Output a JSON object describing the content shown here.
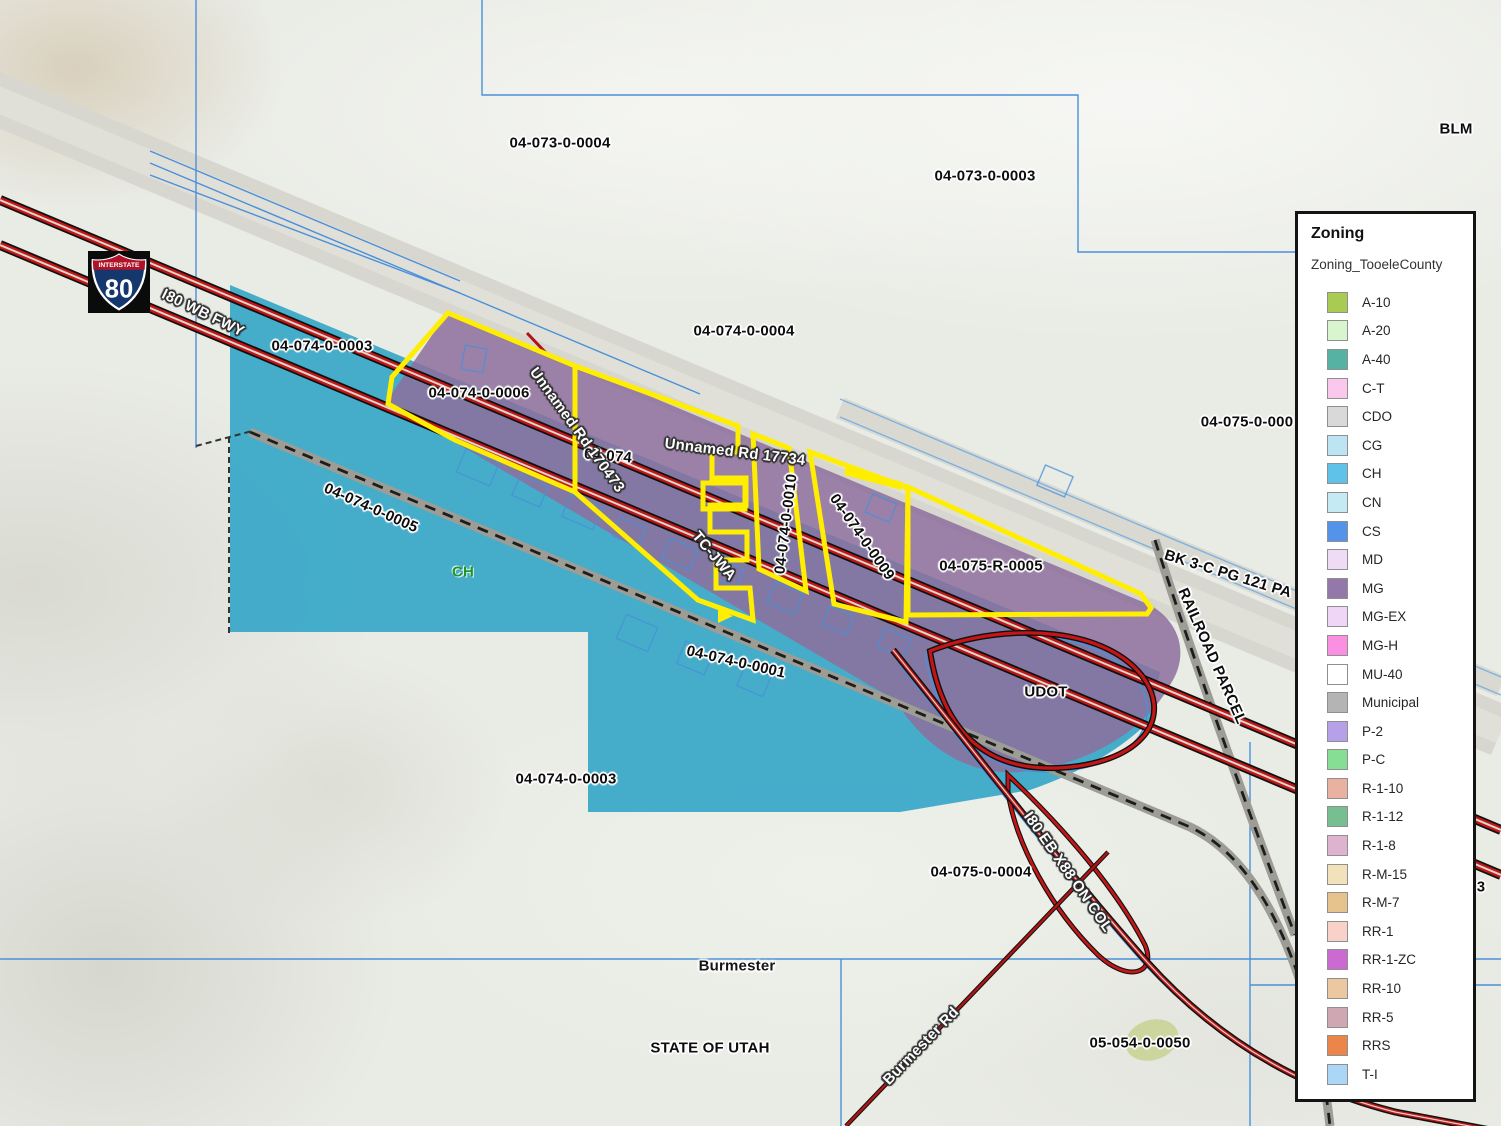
{
  "map": {
    "zone_colors": {
      "ch_fill": "#36a7c8",
      "mg_fill": "#8d6f9c",
      "selection_outline": "#ffee00",
      "parcel_line": "#4a90d9",
      "road_red": "#c41616"
    },
    "shield": {
      "top": "INTERSTATE",
      "number": "80"
    },
    "labels": [
      {
        "text": "04-073-0-0004",
        "x": 560,
        "y": 143,
        "r": 0,
        "kind": "parcel"
      },
      {
        "text": "04-073-0-0003",
        "x": 985,
        "y": 176,
        "r": 0,
        "kind": "parcel"
      },
      {
        "text": "BLM",
        "x": 1456,
        "y": 129,
        "r": 0,
        "kind": "parcel"
      },
      {
        "text": "04-074-0-0004",
        "x": 744,
        "y": 331,
        "r": 0,
        "kind": "parcel"
      },
      {
        "text": "04-074-0-0003",
        "x": 322,
        "y": 346,
        "r": 0,
        "kind": "parcel"
      },
      {
        "text": "04-074-0-0006",
        "x": 479,
        "y": 393,
        "r": 0,
        "kind": "parcel"
      },
      {
        "text": "04-074-0-0005",
        "x": 371,
        "y": 508,
        "r": 24,
        "kind": "parcel"
      },
      {
        "text": "04-074",
        "x": 608,
        "y": 456,
        "r": 5,
        "kind": "parcel"
      },
      {
        "text": "Unnamed Rd 170473",
        "x": 577,
        "y": 430,
        "r": 54,
        "kind": "road"
      },
      {
        "text": "Unnamed Rd 17734",
        "x": 735,
        "y": 452,
        "r": 7,
        "kind": "road"
      },
      {
        "text": "04-074-0-0010",
        "x": 786,
        "y": 524,
        "r": -83,
        "kind": "parcel"
      },
      {
        "text": "04-074-0-0009",
        "x": 862,
        "y": 537,
        "r": 55,
        "kind": "parcel"
      },
      {
        "text": "04-075-R-0005",
        "x": 991,
        "y": 566,
        "r": 0,
        "kind": "parcel"
      },
      {
        "text": "CH",
        "x": 463,
        "y": 572,
        "r": 0,
        "kind": "zone"
      },
      {
        "text": "TC-JWA",
        "x": 714,
        "y": 556,
        "r": 50,
        "kind": "road"
      },
      {
        "text": "BK 3-C PG 121 PA",
        "x": 1228,
        "y": 574,
        "r": 17,
        "kind": "parcel"
      },
      {
        "text": "RAILROAD PARCEL",
        "x": 1212,
        "y": 656,
        "r": 66,
        "kind": "parcel"
      },
      {
        "text": "UDOT",
        "x": 1046,
        "y": 692,
        "r": 0,
        "kind": "parcel"
      },
      {
        "text": "04-074-0-0001",
        "x": 736,
        "y": 662,
        "r": 13,
        "kind": "parcel"
      },
      {
        "text": "04-074-0-0003",
        "x": 566,
        "y": 779,
        "r": 0,
        "kind": "parcel"
      },
      {
        "text": "04-075-0-0004",
        "x": 981,
        "y": 872,
        "r": 0,
        "kind": "parcel"
      },
      {
        "text": "04-075-0-000",
        "x": 1247,
        "y": 422,
        "r": 0,
        "kind": "parcel"
      },
      {
        "text": "3",
        "x": 1481,
        "y": 887,
        "r": 0,
        "kind": "parcel"
      },
      {
        "text": "I80 WB FWY",
        "x": 203,
        "y": 313,
        "r": 26,
        "kind": "road"
      },
      {
        "text": "I80 EB X88 ON COL",
        "x": 1068,
        "y": 872,
        "r": 55,
        "kind": "road"
      },
      {
        "text": "Burmester Rd",
        "x": 921,
        "y": 1046,
        "r": -46,
        "kind": "road"
      },
      {
        "text": "Burmester",
        "x": 737,
        "y": 966,
        "r": 0,
        "kind": "city"
      },
      {
        "text": "STATE OF UTAH",
        "x": 710,
        "y": 1048,
        "r": 0,
        "kind": "state"
      },
      {
        "text": "05-054-0-0050",
        "x": 1140,
        "y": 1043,
        "r": 0,
        "kind": "parcel"
      }
    ]
  },
  "legend": {
    "title": "Zoning",
    "layer": "Zoning_TooeleCounty",
    "items": [
      {
        "label": "A-10",
        "color": "#a9cb52"
      },
      {
        "label": "A-20",
        "color": "#d9f5cd"
      },
      {
        "label": "A-40",
        "color": "#56b3a3"
      },
      {
        "label": "C-T",
        "color": "#f9c8ec"
      },
      {
        "label": "CDO",
        "color": "#d9d9d9"
      },
      {
        "label": "CG",
        "color": "#bce4f3"
      },
      {
        "label": "CH",
        "color": "#5fc3e9"
      },
      {
        "label": "CN",
        "color": "#c5eaf3"
      },
      {
        "label": "CS",
        "color": "#5394ea"
      },
      {
        "label": "MD",
        "color": "#eedcf7"
      },
      {
        "label": "MG",
        "color": "#9378a9"
      },
      {
        "label": "MG-EX",
        "color": "#efd6f7"
      },
      {
        "label": "MG-H",
        "color": "#fb90e3"
      },
      {
        "label": "MU-40",
        "color": "#ffffff"
      },
      {
        "label": "Municipal",
        "color": "#b4b4b4"
      },
      {
        "label": "P-2",
        "color": "#b6a1e9"
      },
      {
        "label": "P-C",
        "color": "#85de93"
      },
      {
        "label": "R-1-10",
        "color": "#e9b19f"
      },
      {
        "label": "R-1-12",
        "color": "#77be90"
      },
      {
        "label": "R-1-8",
        "color": "#ddb3d0"
      },
      {
        "label": "R-M-15",
        "color": "#f2e2bb"
      },
      {
        "label": "R-M-7",
        "color": "#e6c38d"
      },
      {
        "label": "RR-1",
        "color": "#f8d2c8"
      },
      {
        "label": "RR-1-ZC",
        "color": "#cb6bd1"
      },
      {
        "label": "RR-10",
        "color": "#ecc79f"
      },
      {
        "label": "RR-5",
        "color": "#cfa7b2"
      },
      {
        "label": "RRS",
        "color": "#ec854a"
      },
      {
        "label": "T-I",
        "color": "#acd6f5"
      }
    ]
  }
}
